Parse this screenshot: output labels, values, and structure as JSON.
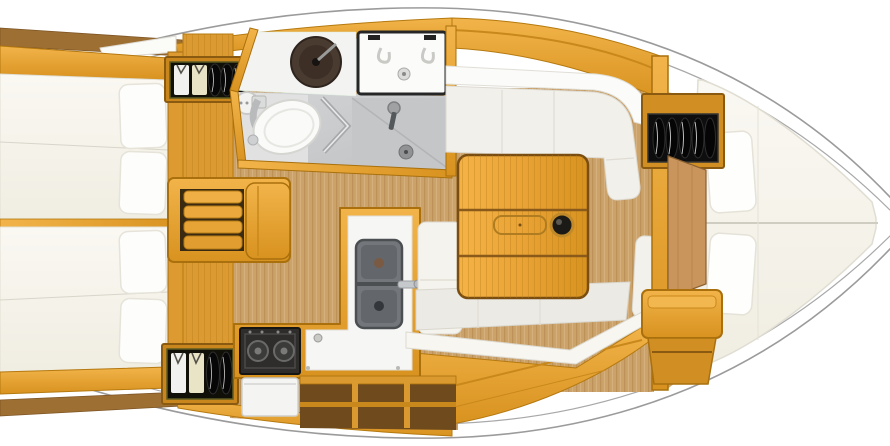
{
  "diagram": {
    "kind": "sailing-yacht-interior-floor-plan",
    "orientation": {
      "bow_side": "right",
      "stern_side": "left"
    }
  },
  "rooms": {
    "hull": {
      "label": "Hull outline"
    },
    "aft_cabin_port": {
      "label": "Aft double cabin (top)"
    },
    "aft_cabin_starboard": {
      "label": "Aft double cabin (bottom)"
    },
    "companionway": {
      "label": "Companionway steps"
    },
    "head": {
      "label": "Head with shower"
    },
    "galley": {
      "label": "L-shaped galley"
    },
    "saloon": {
      "label": "Saloon with folding table"
    },
    "forward_cabin": {
      "label": "Forward V-berth cabin"
    }
  },
  "fixtures": {
    "wardrobe_port": {
      "label": "Hanging locker with clothes"
    },
    "wardrobe_starboard": {
      "label": "Hanging locker with clothes"
    },
    "wardrobe_forward": {
      "label": "Hanging locker with clothes"
    },
    "round_basin": {
      "label": "Round washbasin"
    },
    "sink_unit": {
      "label": "Vanity sink unit"
    },
    "toilet": {
      "label": "Marine toilet"
    },
    "shower": {
      "label": "Shower stall with folding door"
    },
    "galley_sinks": {
      "label": "Double galley sink"
    },
    "stove": {
      "label": "Two-burner stove"
    },
    "oven": {
      "label": "Oven door"
    },
    "saloon_table": {
      "label": "Folding saloon table"
    },
    "settee_top": {
      "label": "Saloon settee (top)"
    },
    "settee_bottom": {
      "label": "Saloon settee (bottom)"
    },
    "v_berth": {
      "label": "V-berth mattress"
    },
    "forward_door": {
      "label": "Forward cabin door"
    },
    "forward_bench": {
      "label": "Forward cabin bench"
    }
  },
  "palette": {
    "wood_gold": "#E8A53E",
    "wood_gold_dark": "#C07F1D",
    "wood_edge": "#A9700D",
    "wood_brown": "#9E6F33",
    "floor_tan": "#CBA26A",
    "hull_line": "#9B9B9B",
    "mattress": "#F8F6EE",
    "cushion": "#F1F0EA",
    "shower_gray": "#C9CBCD",
    "appliance_dark": "#2B2B2B"
  }
}
